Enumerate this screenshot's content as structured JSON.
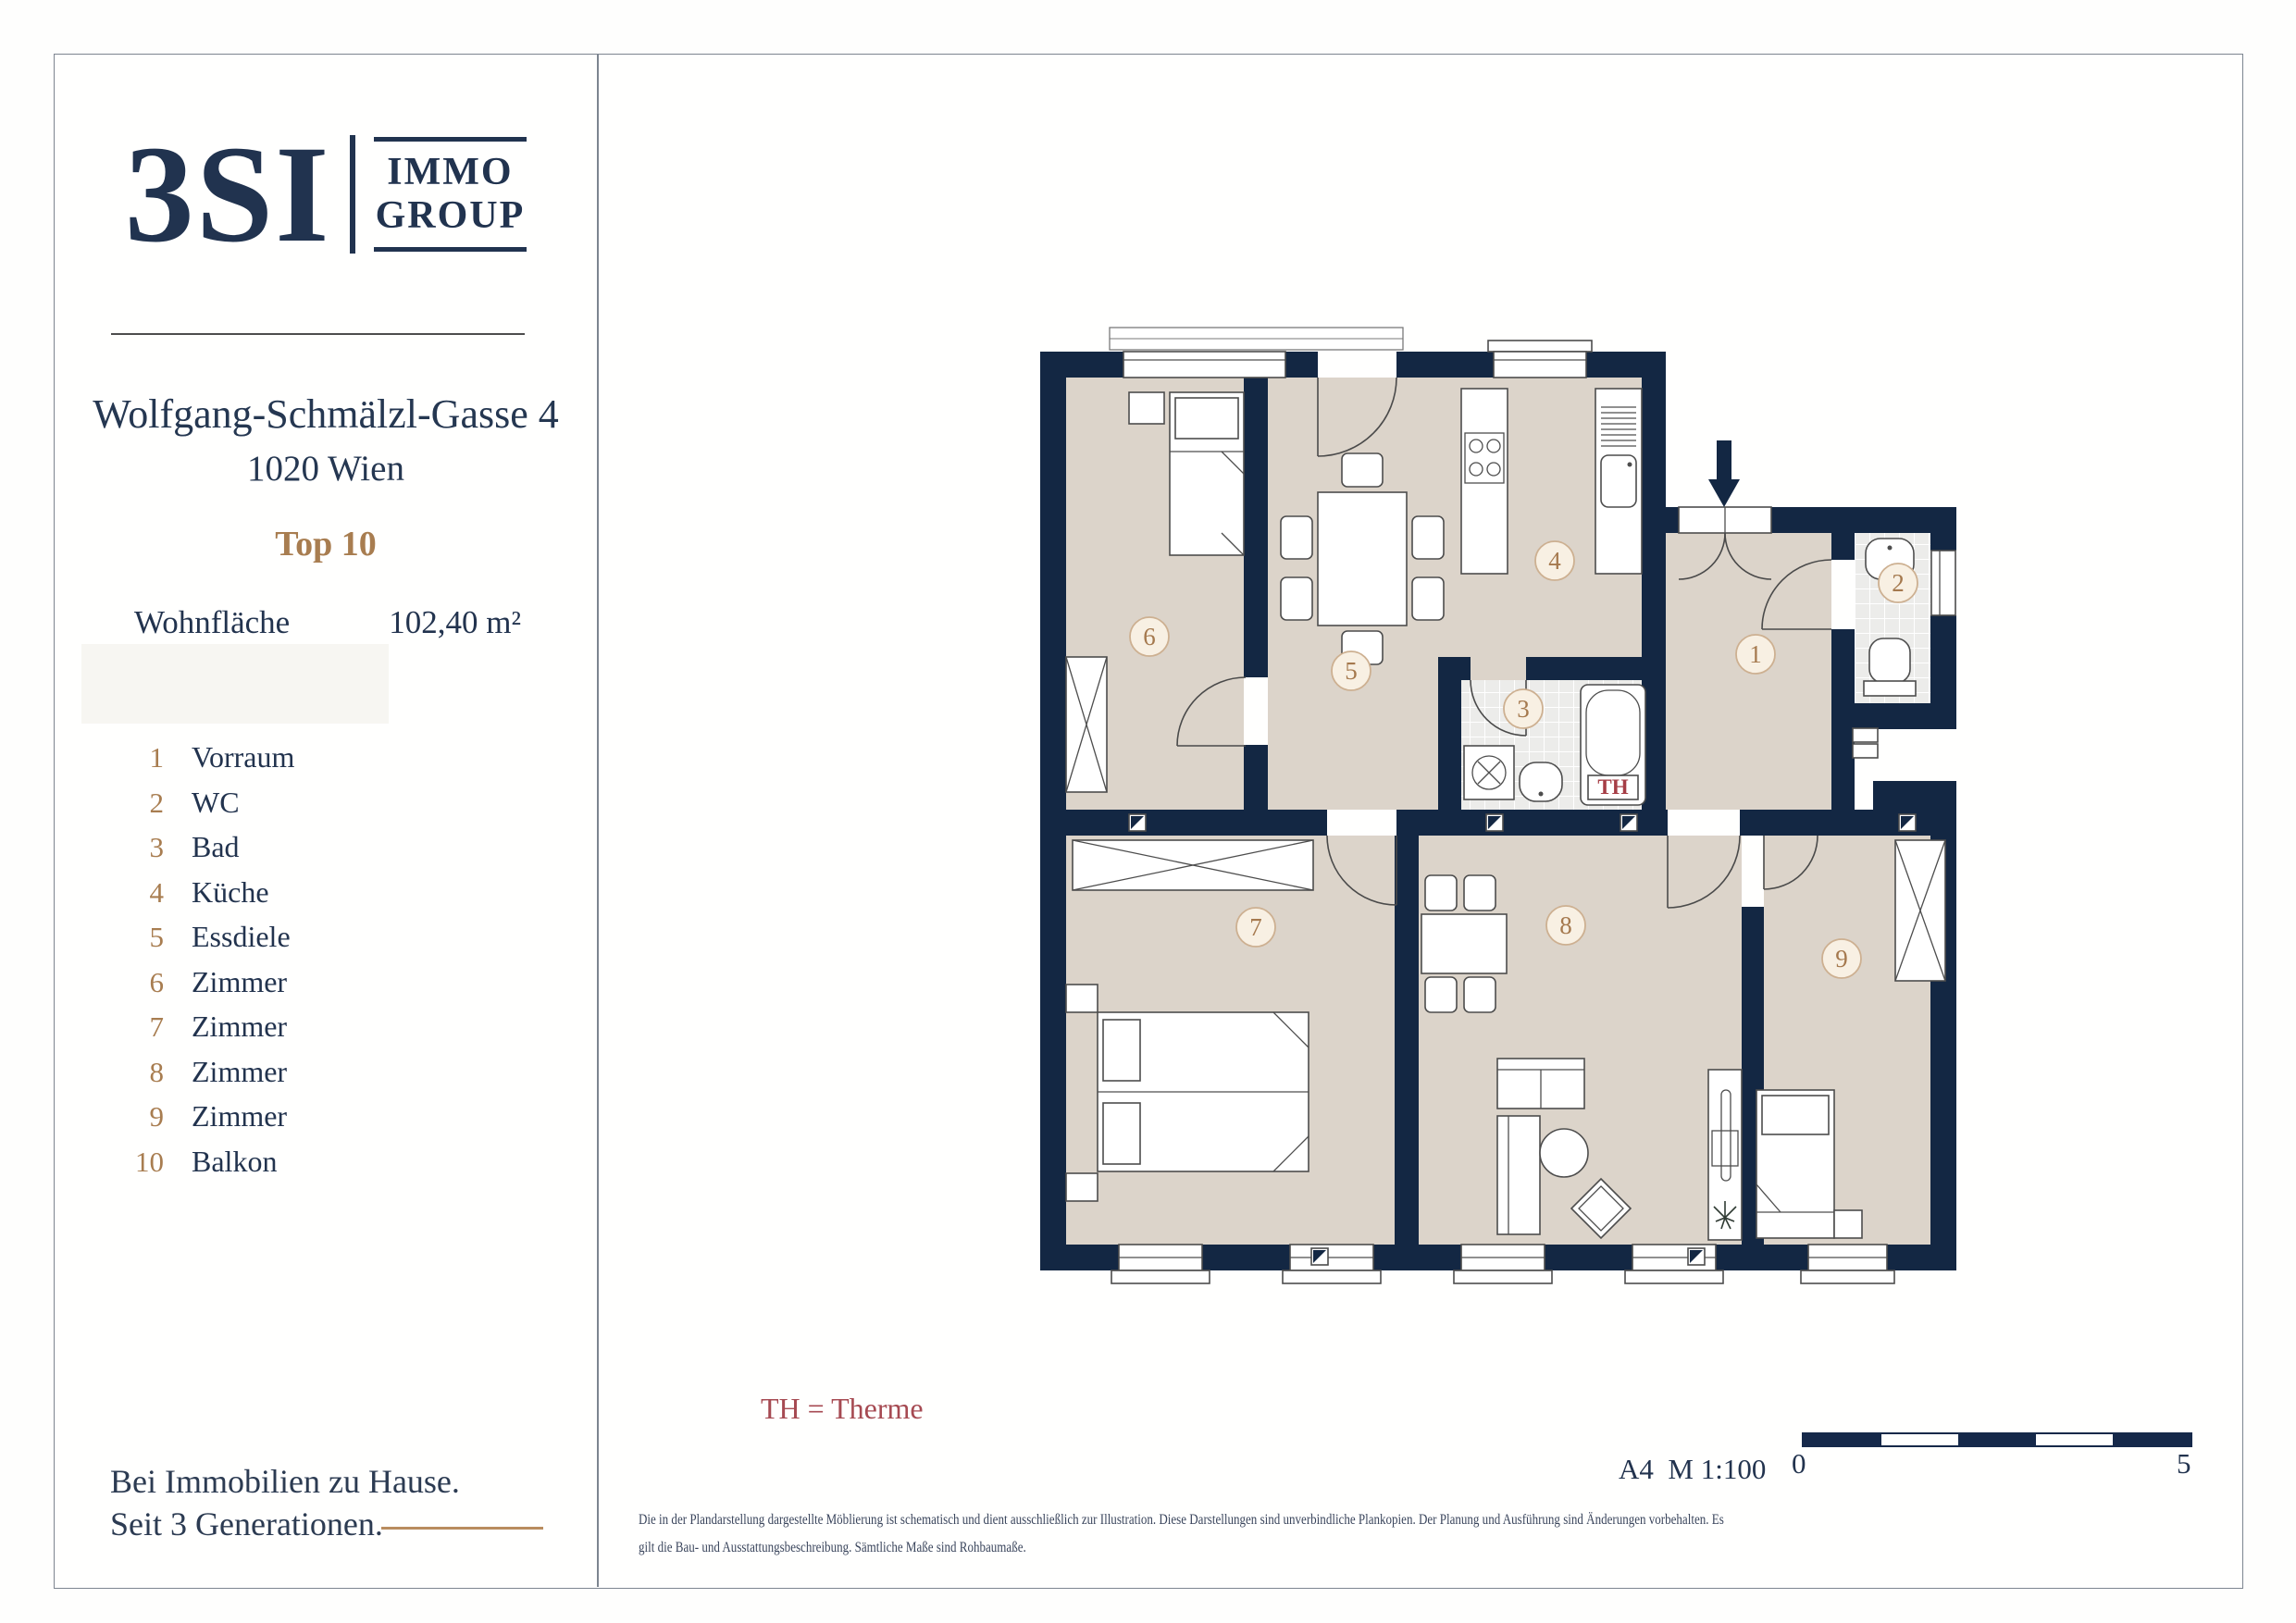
{
  "colors": {
    "navy": "#21334f",
    "wall_navy": "#132743",
    "floor_beige": "#dcd4ca",
    "accent_tan": "#a87d50",
    "th_red": "#a64a52",
    "border_gray": "#7d8590"
  },
  "sidebar": {
    "logo": {
      "main": "3SI",
      "sub_top": "IMMO",
      "sub_bottom": "GROUP"
    },
    "address_line1": "Wolfgang-Schmälzl-Gasse 4",
    "address_line2": "1020 Wien",
    "unit": "Top 10",
    "area_label": "Wohnfläche",
    "area_value": "102,40 m²",
    "legend": [
      {
        "num": "1",
        "label": "Vorraum"
      },
      {
        "num": "2",
        "label": "WC"
      },
      {
        "num": "3",
        "label": "Bad"
      },
      {
        "num": "4",
        "label": "Küche"
      },
      {
        "num": "5",
        "label": "Essdiele"
      },
      {
        "num": "6",
        "label": "Zimmer"
      },
      {
        "num": "7",
        "label": "Zimmer"
      },
      {
        "num": "8",
        "label": "Zimmer"
      },
      {
        "num": "9",
        "label": "Zimmer"
      },
      {
        "num": "10",
        "label": "Balkon"
      }
    ],
    "tagline_line1": "Bei Immobilien zu Hause.",
    "tagline_line2": "Seit 3 Generationen."
  },
  "plan": {
    "rooms": [
      "1",
      "2",
      "3",
      "4",
      "5",
      "6",
      "7",
      "8",
      "9"
    ],
    "th_label": "TH",
    "th_note": "TH = Therme",
    "scale_text": "A4  M 1:100",
    "scale_start": "0",
    "scale_end": "5",
    "disclaimer_line1": "Die in der Plandarstellung dargestellte Möblierung ist schematisch und dient ausschließlich zur Illustration. Diese Darstellungen sind unverbindliche Plankopien. Der Planung und Ausführung sind Änderungen vorbehalten. Es",
    "disclaimer_line2": "gilt die Bau- und Ausstattungsbeschreibung. Sämtliche Maße sind Rohbaumaße."
  }
}
